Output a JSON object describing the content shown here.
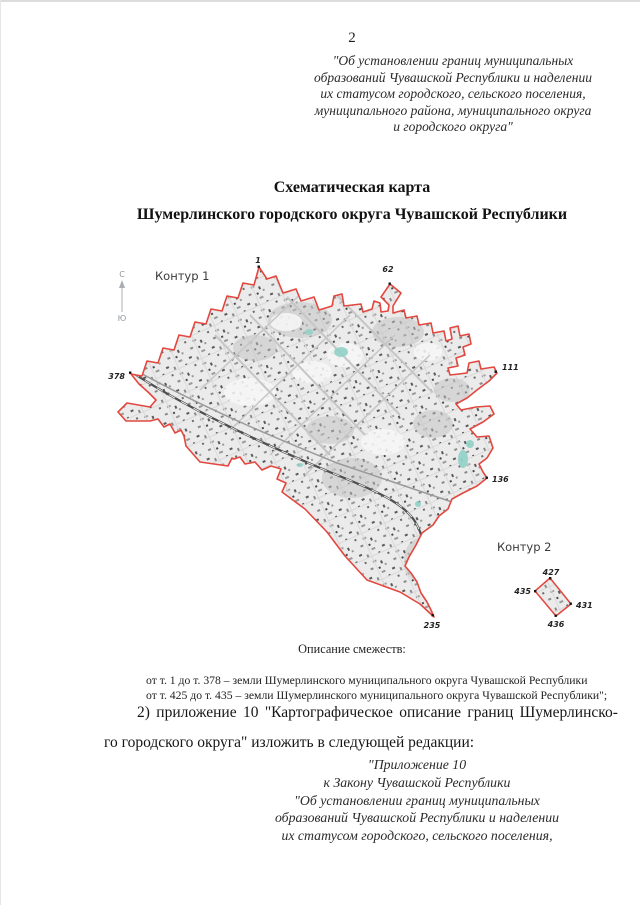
{
  "document": {
    "page_number": "2",
    "header_quote_lines": [
      "\"Об установлении границ муниципальных",
      "образований Чувашской Республики и наделении",
      "их статусом городского, сельского поселения,",
      "муниципального района, муниципального округа",
      "и городского округа\""
    ],
    "title_line1": "Схематическая карта",
    "title_line2": "Шумерлинского городского округа Чувашской Республики",
    "adjacency_heading": "Описание смежеств:",
    "adjacency_line1": "от т. 1 до т. 378 – земли Шумерлинского муниципального округа Чувашской Республики",
    "adjacency_line2": "от т. 425 до т. 435 – земли Шумерлинского муниципального округа Чувашской Республики\";",
    "amendment_line1": "2) приложение 10 \"Картографическое описание границ Шумерлинско-",
    "amendment_line2": "го городского округа\" изложить в следующей редакции:",
    "footer_quote_lines": [
      "\"Приложение 10",
      "к Закону Чувашской Республики",
      "\"Об установлении границ муниципальных",
      "образований Чувашской Республики и наделении",
      "их статусом городского, сельского поселения,"
    ]
  },
  "map": {
    "contour1_label": "Контур 1",
    "contour2_label": "Контур 2",
    "compass_north": "С",
    "compass_south": "Ю",
    "boundary_color": "#e2483f",
    "points": {
      "p1": "1",
      "p62": "62",
      "p111": "111",
      "p136": "136",
      "p235": "235",
      "p378": "378",
      "p427": "427",
      "p431": "431",
      "p435": "435",
      "p436": "436"
    }
  }
}
